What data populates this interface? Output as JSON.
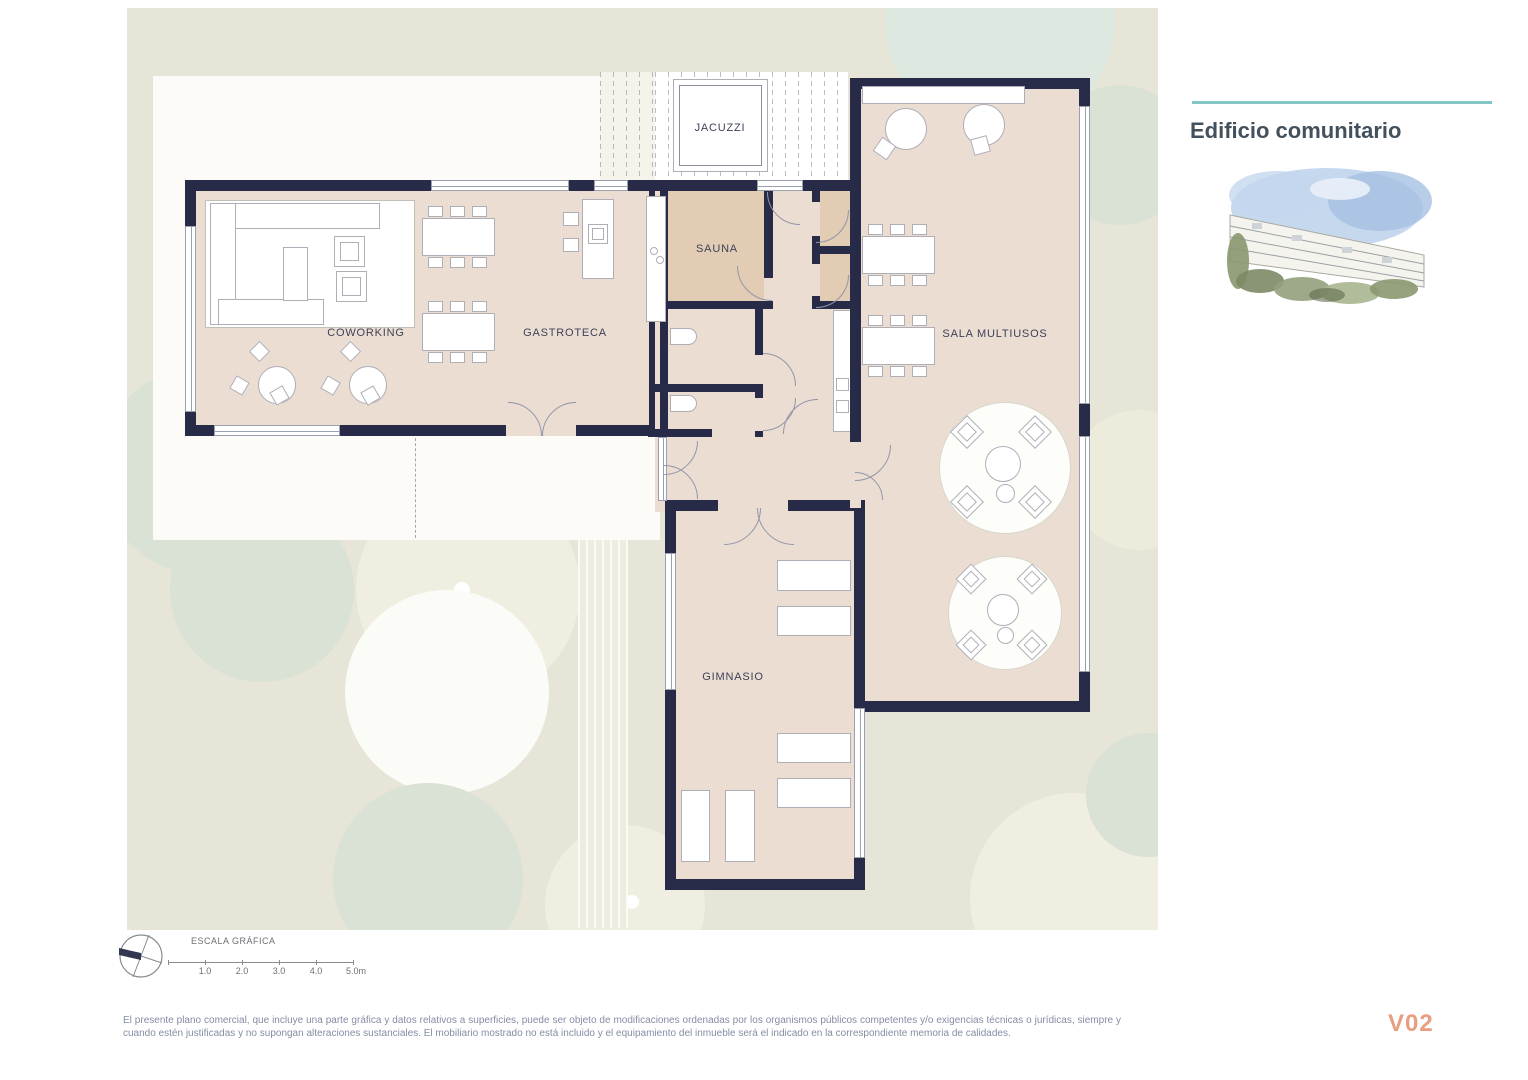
{
  "header": {
    "title": "Edificio comunitario"
  },
  "rooms": {
    "jacuzzi": "JACUZZI",
    "sauna": "SAUNA",
    "coworking": "COWORKING",
    "gastroteca": "GASTROTECA",
    "sala_multiusos": "SALA MULTIUSOS",
    "gimnasio": "GIMNASIO"
  },
  "scale": {
    "title": "ESCALA GRÁFICA",
    "ticks": [
      "1.0",
      "2.0",
      "3.0",
      "4.0",
      "5.0m"
    ]
  },
  "footer": {
    "disclaimer": "El presente plano comercial, que incluye una parte gráfica y datos relativos a superficies, puede ser objeto de modificaciones ordenadas por los organismos públicos competentes y/o exigencias técnicas o jurídicas, siempre y cuando estén justificadas y no supongan alteraciones sustanciales. El mobiliario mostrado no está incluido y el equipamiento del inmueble será el indicado en la correspondiente memoria de calidades.",
    "version": "V02"
  },
  "icons": {
    "compass": "north-compass",
    "building_illustration": "building-watercolor"
  },
  "colors": {
    "wall": "#272b48",
    "floor": "#ecddd3",
    "sauna": "#e3ccb4",
    "site": "#e6e5d7",
    "accent": "#84c5c6",
    "title": "#44515d",
    "version": "#e79f80",
    "label": "#3c4258",
    "muted": "#848da4",
    "tree-green": "#d9e2d4",
    "tree-beige": "#f0eee0"
  }
}
